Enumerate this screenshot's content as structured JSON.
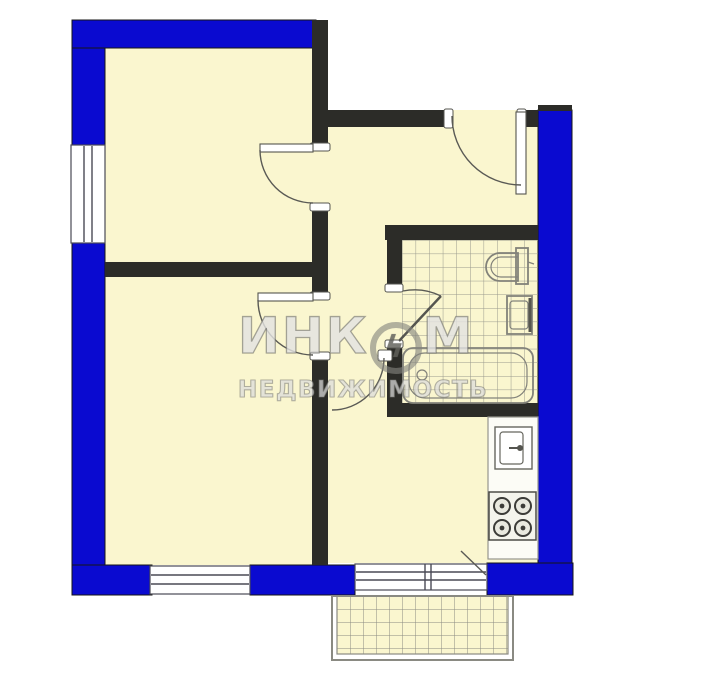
{
  "watermark": {
    "brand_left": "ИНК",
    "bolt": "ϟ",
    "brand_right": "М",
    "subtitle": "НЕДВИЖИМОСТЬ"
  },
  "colors": {
    "wall_blue": "#0a0ad0",
    "wall_black": "#2c2c28",
    "floor": "#faf6cf",
    "tile_line": "#98988c",
    "fixture_line": "#82827a",
    "window_line": "#4a4a55",
    "balcony_line": "#8a8a82",
    "door_line": "#5a5a55"
  }
}
